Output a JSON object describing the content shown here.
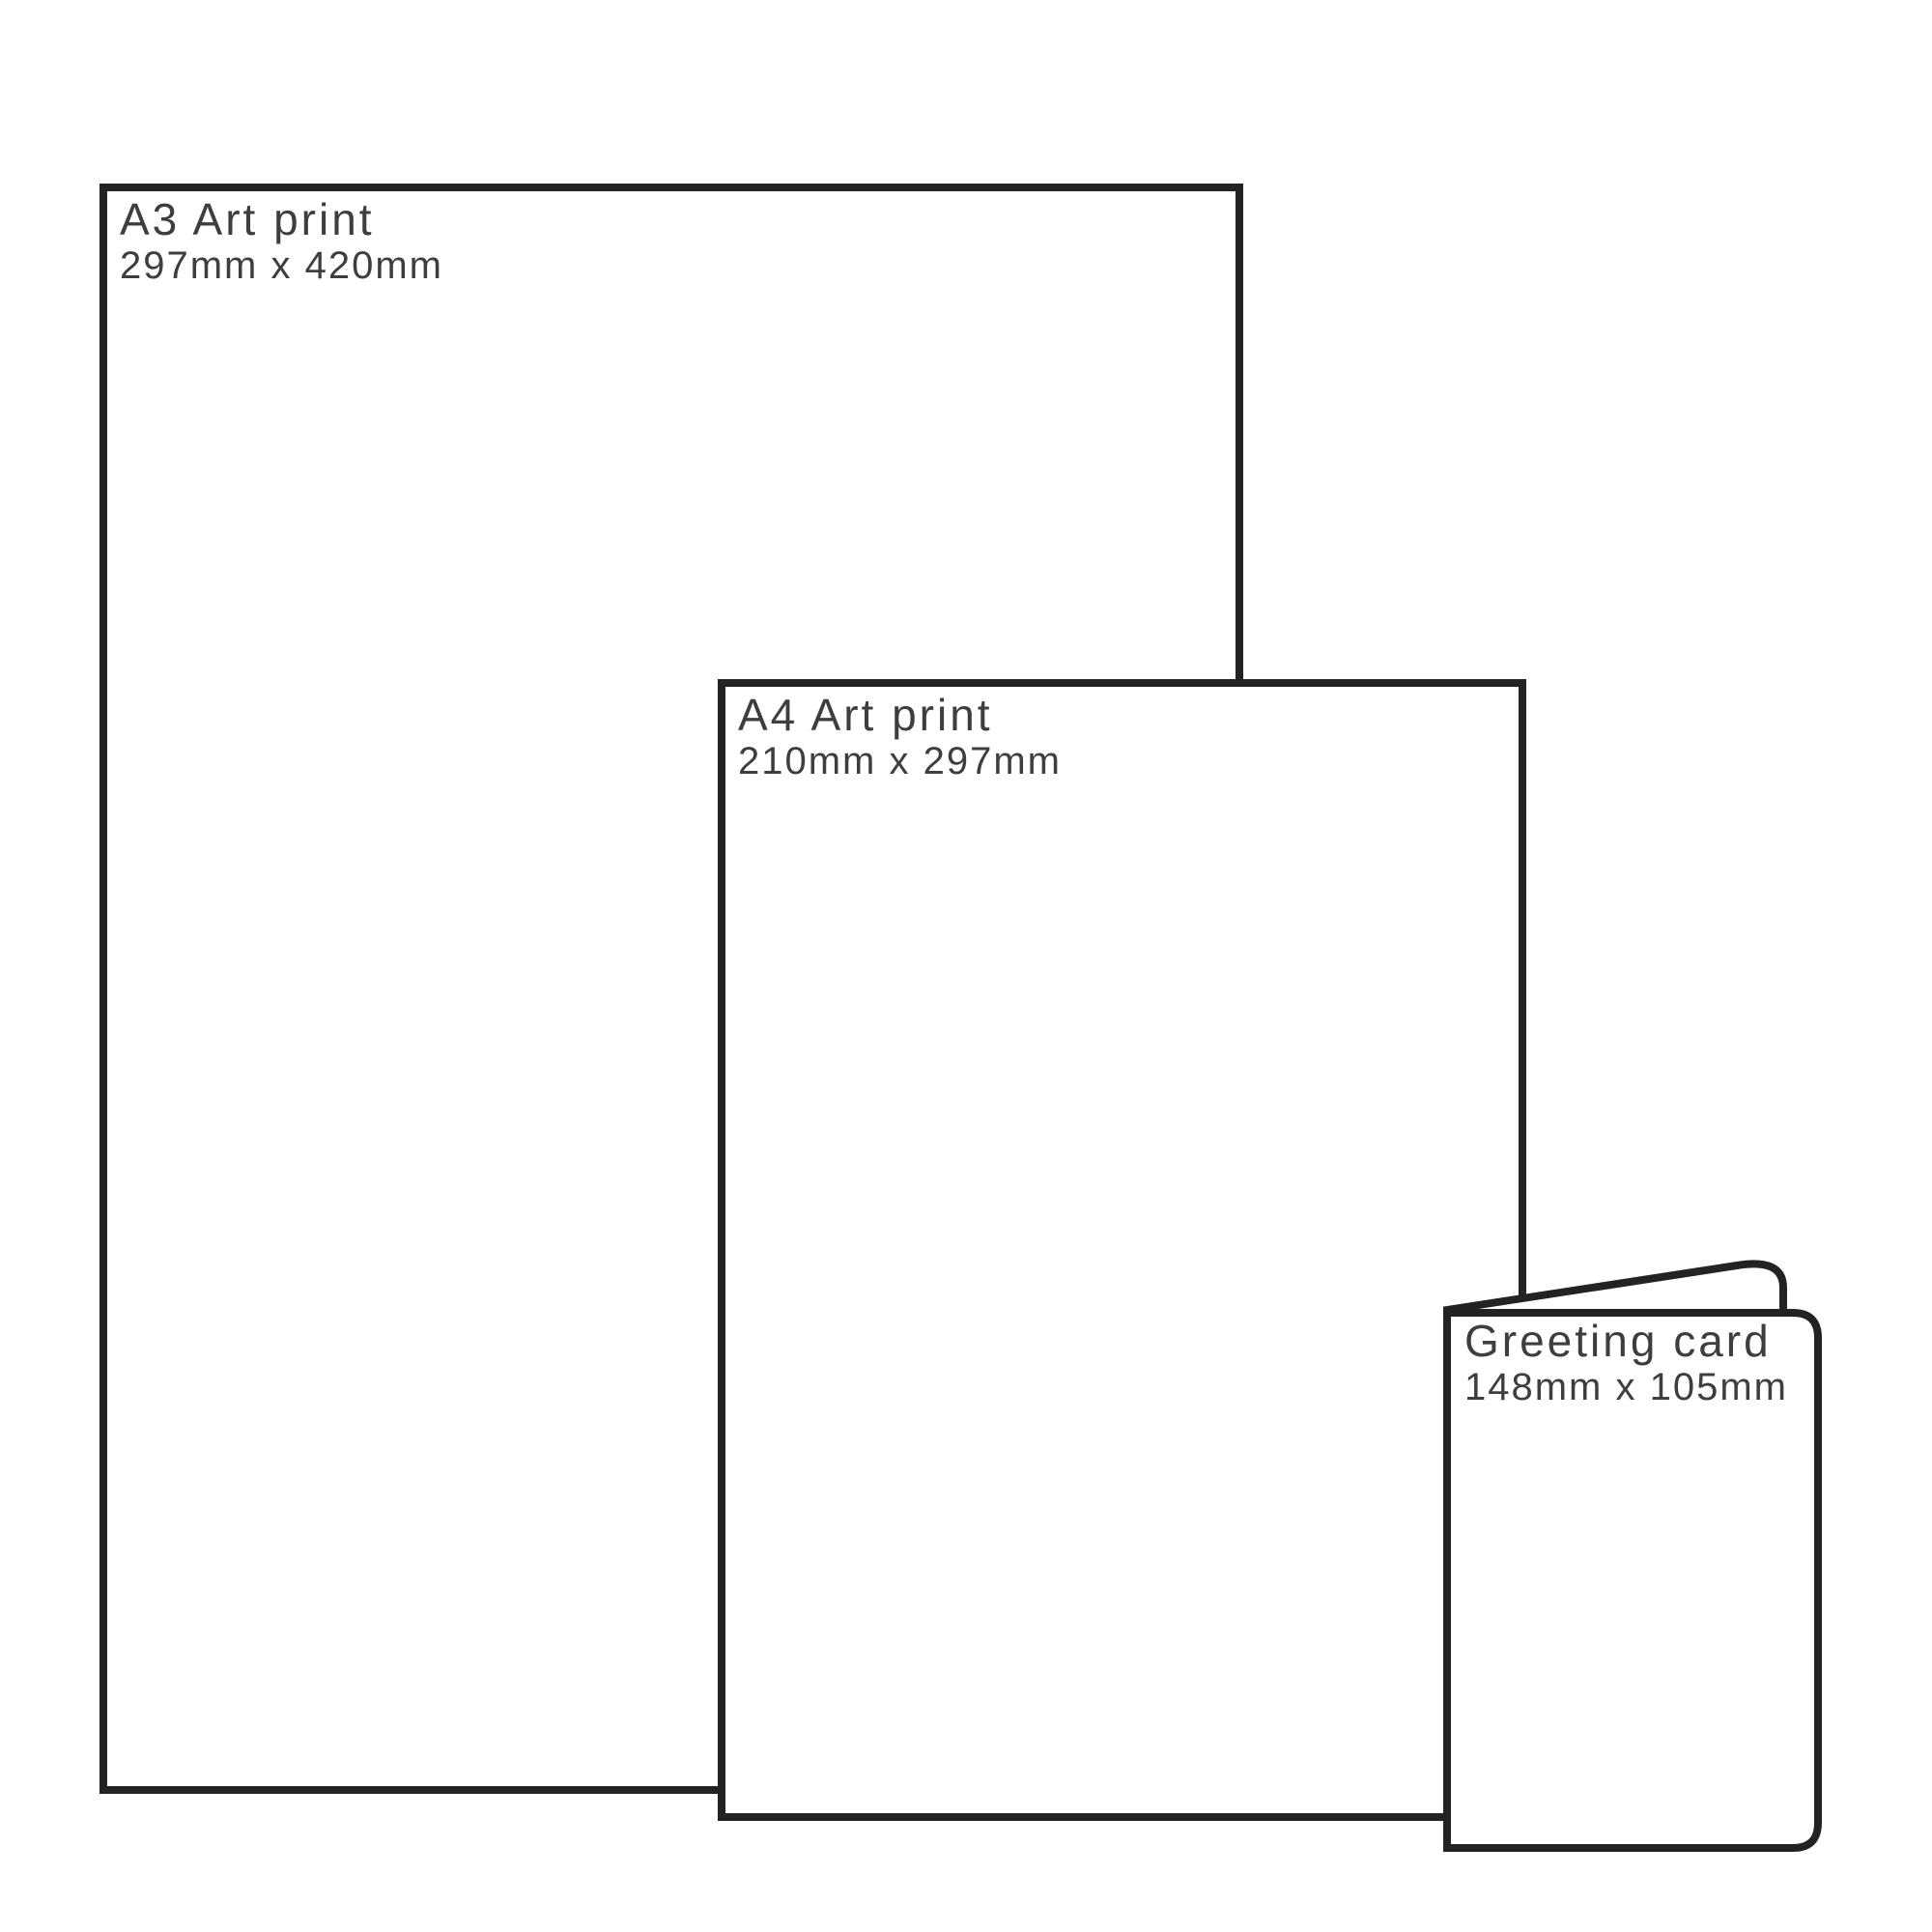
{
  "colors": {
    "background": "#ffffff",
    "outline": "#232323",
    "text": "#3e3e3e"
  },
  "items": [
    {
      "id": "a3-art-print",
      "title": "A3 Art print",
      "size": "297mm x 420mm"
    },
    {
      "id": "a4-art-print",
      "title": "A4 Art print",
      "size": "210mm x 297mm"
    },
    {
      "id": "greeting-card",
      "title": "Greeting card",
      "size": "148mm x 105mm"
    }
  ]
}
